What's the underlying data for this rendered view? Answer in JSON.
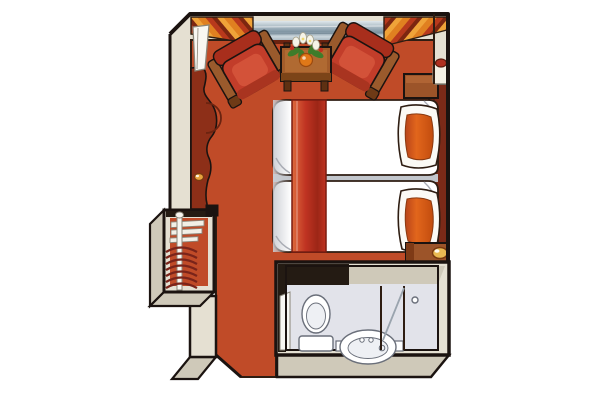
{
  "meta": {
    "title": "Ship cabin floor plan",
    "type": "isometric floor-plan illustration",
    "rooms": [
      "bedroom with sitting area",
      "wardrobe nook",
      "entry corridor",
      "bathroom"
    ],
    "furniture": [
      "picture window",
      "striped curtains left",
      "striped curtains right",
      "armchair left",
      "armchair right",
      "coffee table",
      "flower bouquet",
      "twin bed 1",
      "twin bed 2",
      "red bed runner",
      "orange pillow 1",
      "orange pillow 2",
      "headboard",
      "nightstand top with lamp",
      "nightstand bottom with lamp",
      "vanity console",
      "open cabin door panel",
      "wardrobe with hanging rod and coat hangers",
      "entry door opening",
      "toilet",
      "washbasin",
      "shower screen",
      "bathroom door with knob"
    ]
  },
  "colors": {
    "bg": "#ffffff",
    "outline": "#1b1310",
    "line": "#2e1d12",
    "wall_face": "#e5e0d2",
    "wall_shade": "#cfc9b9",
    "carpet": "#c04b28",
    "console_dark": "#8d2f18",
    "sill": "#6b2310",
    "glass_light": "#dfe7eb",
    "glass_mid": "#9fb0bb",
    "glass_dark": "#7e93a1",
    "glass_pale": "#ccd7dd",
    "curtain_1": "#e08020",
    "curtain_2": "#b8391c",
    "curtain_3": "#7c2610",
    "curtain_4": "#efa339",
    "chair_red": "#c23d2a",
    "chair_red_hl": "#d8593f",
    "chair_back": "#a82e1c",
    "chair_front": "#a93420",
    "wood": "#9a5a2c",
    "wood_dark": "#6e3a16",
    "table_top": "#a35c2a",
    "table_inner": "#b06a32",
    "table_face": "#7c4418",
    "table_leg": "#5e3012",
    "duvet": "#ffffff",
    "duvet_line": "#a9acb4",
    "seam": "#c2c6cc",
    "runner_light": "#dd6a3c",
    "runner_mid": "#c03322",
    "runner_deep": "#9c2616",
    "runner_edge": "#7a1c10",
    "pillow_frame": "#fbfaf5",
    "pillow_dark": "#b8441a",
    "pillow_light": "#e2661c",
    "pillow_deep": "#c24c0e",
    "pillow_edge": "#8a3a10",
    "headboard": "#7b2a18",
    "headboard_line": "#5a1c0e",
    "nightstand": "#9c5429",
    "nightstand_top": "#b06434",
    "nightstand_side": "#7e3a16",
    "lamp_shade": "#f4f0e4",
    "lamp_cap": "#b03020",
    "lamp_gold": "#eaba52",
    "lamp_gold_edge": "#7a4a14",
    "bath_floor": "#e2e3ea",
    "bath_dark": "#241b13",
    "fixture": "#ffffff",
    "fixture_inner": "#eef0f4",
    "fixture_line": "#6a6f7a",
    "door_panel": "#f8f7f2",
    "panel_edge": "#8a8578",
    "rod": "#f8f6f0",
    "shelf": "#f2efe6",
    "shelf_edge": "#8a857a",
    "hanger": "#7a241a",
    "leaf": "#3e7c2a",
    "tulip": "#f6f4e8",
    "tulip_edge": "#a8a48e",
    "flower_orange": "#e07818",
    "flower_orange_edge": "#9c4a0e",
    "flower_red": "#c03020",
    "knob": "#e8a33d",
    "knob_edge": "#7a3a10"
  }
}
